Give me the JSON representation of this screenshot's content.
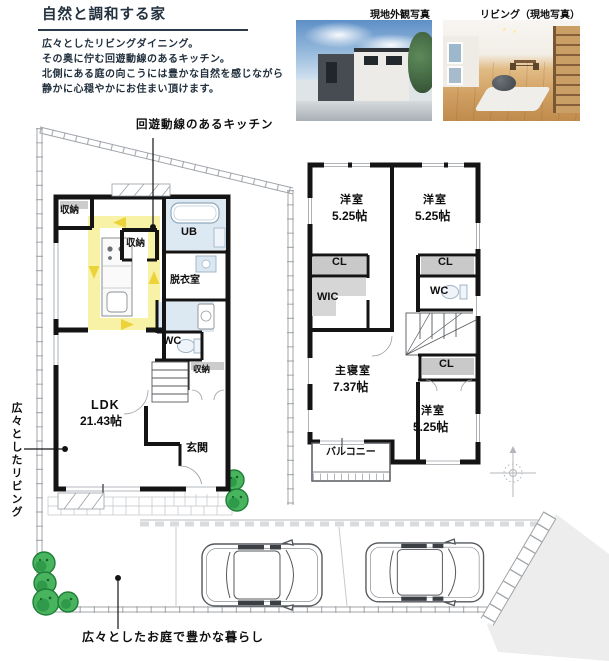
{
  "header": {
    "title": "自然と調和する家",
    "description_lines": [
      "広々としたリビングダイニング。",
      "その奥に佇む回遊動線のあるキッチン。",
      "北側にある庭の向こうには豊かな自然を感じながら",
      "静かに心穏やかにお住まい頂けます。"
    ]
  },
  "photos": [
    {
      "label": "現地外観写真"
    },
    {
      "label": "リビング（現地写真）"
    }
  ],
  "annotations": {
    "kitchen": "回遊動線のあるキッチン",
    "living": "広々としたリビング",
    "garden": "広々としたお庭で豊かな暮らし"
  },
  "floor1": {
    "rooms": {
      "closet_top_left": "収納",
      "closet_kitchen": "収納",
      "unit_bath": "UB",
      "dressing_room": "脱衣室",
      "toilet": "WC",
      "closet_hall": "収納",
      "ldk_name": "LDK",
      "ldk_size": "21.43帖",
      "entrance": "玄関"
    }
  },
  "floor2": {
    "rooms": {
      "bedroom_a_name": "洋室",
      "bedroom_a_size": "5.25帖",
      "bedroom_b_name": "洋室",
      "bedroom_b_size": "5.25帖",
      "closet_a": "CL",
      "closet_b": "CL",
      "closet_c": "CL",
      "walk_in_closet": "WIC",
      "toilet": "WC",
      "master_name": "主寝室",
      "master_size": "7.37帖",
      "bedroom_c_name": "洋室",
      "bedroom_c_size": "5.25帖",
      "balcony": "バルコニー"
    }
  },
  "colors": {
    "text_navy": "#22303e",
    "wall_black": "#141414",
    "circulation_yellow": "#f8f2a6",
    "arrow_yellow": "#ecd23b",
    "wet_area_blue": "#dde9f2",
    "closet_gray": "#c9c9c9",
    "tree_green": "#3fae5a"
  }
}
